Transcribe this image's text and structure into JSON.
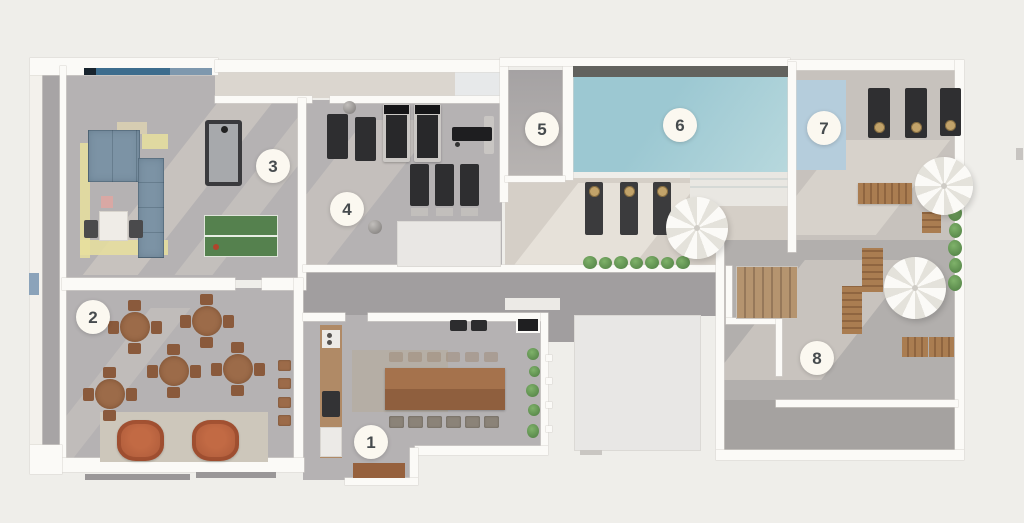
{
  "plan_title": "amenities-floor-plan",
  "markers": [
    {
      "label": "1"
    },
    {
      "label": "2"
    },
    {
      "label": "3"
    },
    {
      "label": "4"
    },
    {
      "label": "5"
    },
    {
      "label": "6"
    },
    {
      "label": "7"
    },
    {
      "label": "8"
    }
  ],
  "colors": {
    "background": "#efeeea",
    "wall": "#fbfaf7",
    "wall_shadow": "#d9d6d1",
    "floor_gray": "#b5b2b3",
    "floor_gray_dark": "#a19e9f",
    "floor_light": "#dbd6cf",
    "deck": "#d5cfc7",
    "terrace": "#b2afad",
    "terrace_dark": "#a5a2a0",
    "pool_water": "#a6cdd5",
    "pool_edge": "#62625e",
    "pool_shelf": "#e9e7e2",
    "blue_mat": "#b5cddc",
    "window_blue": "#3d6d8e",
    "window_navy": "#18242e",
    "sofa": "#7c93a5",
    "rug_yellow": "#e7df9e",
    "rug_beige": "#cdc7bb",
    "wood": "#9c6b49",
    "wood_dark": "#8a5a3c",
    "armchair": "#b25e3c",
    "pingpong": "#55814e",
    "equipment_dark": "#2e2e30",
    "gold": "#c2a36a",
    "green": "#6a9e58",
    "white_block": "#e8e7e5",
    "marker_bg": "#fbf8f0",
    "marker_text": "#464b4e",
    "umbrella": "#fbfaf7",
    "umbrella_shade": "#e4e2db"
  }
}
